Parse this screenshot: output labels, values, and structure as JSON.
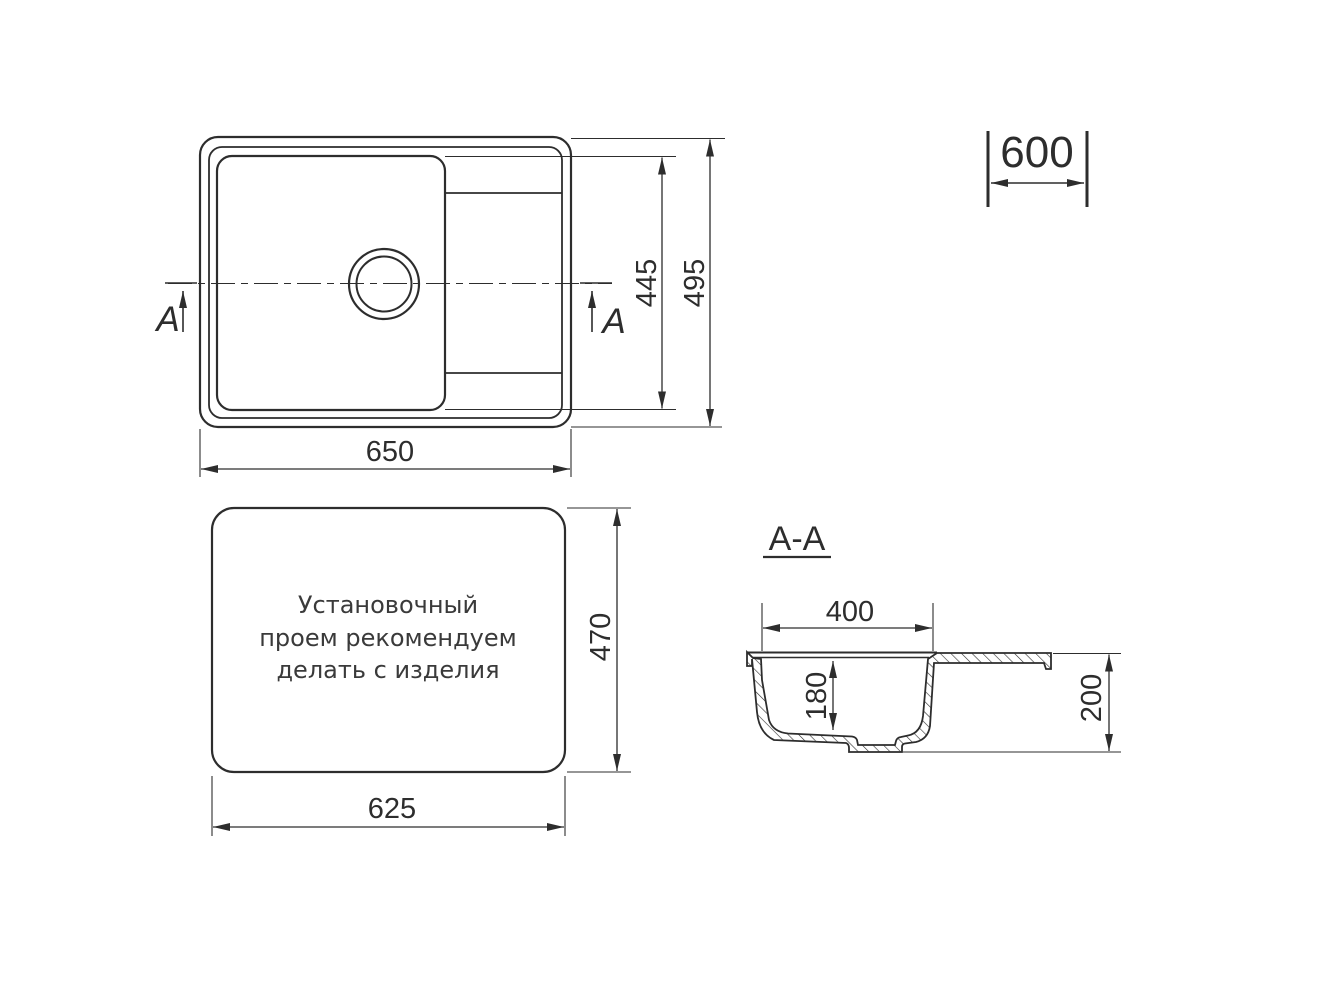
{
  "top_view": {
    "dim_length": "650",
    "dim_bowl_span": "445",
    "dim_width": "495",
    "section_arrow_left_label": "A",
    "section_arrow_right_label": "A"
  },
  "cabinet_dim": {
    "value": "600"
  },
  "cutout_view": {
    "note": [
      "Установочный",
      "проем рекомендуем",
      "делать с изделия"
    ],
    "dim_length": "625",
    "dim_width": "470"
  },
  "section_view": {
    "title": "A-A",
    "dim_bowl_width": "400",
    "dim_bowl_depth": "180",
    "dim_overall_depth": "200"
  },
  "colors": {
    "line": "#2d2d2d",
    "background": "#ffffff"
  }
}
